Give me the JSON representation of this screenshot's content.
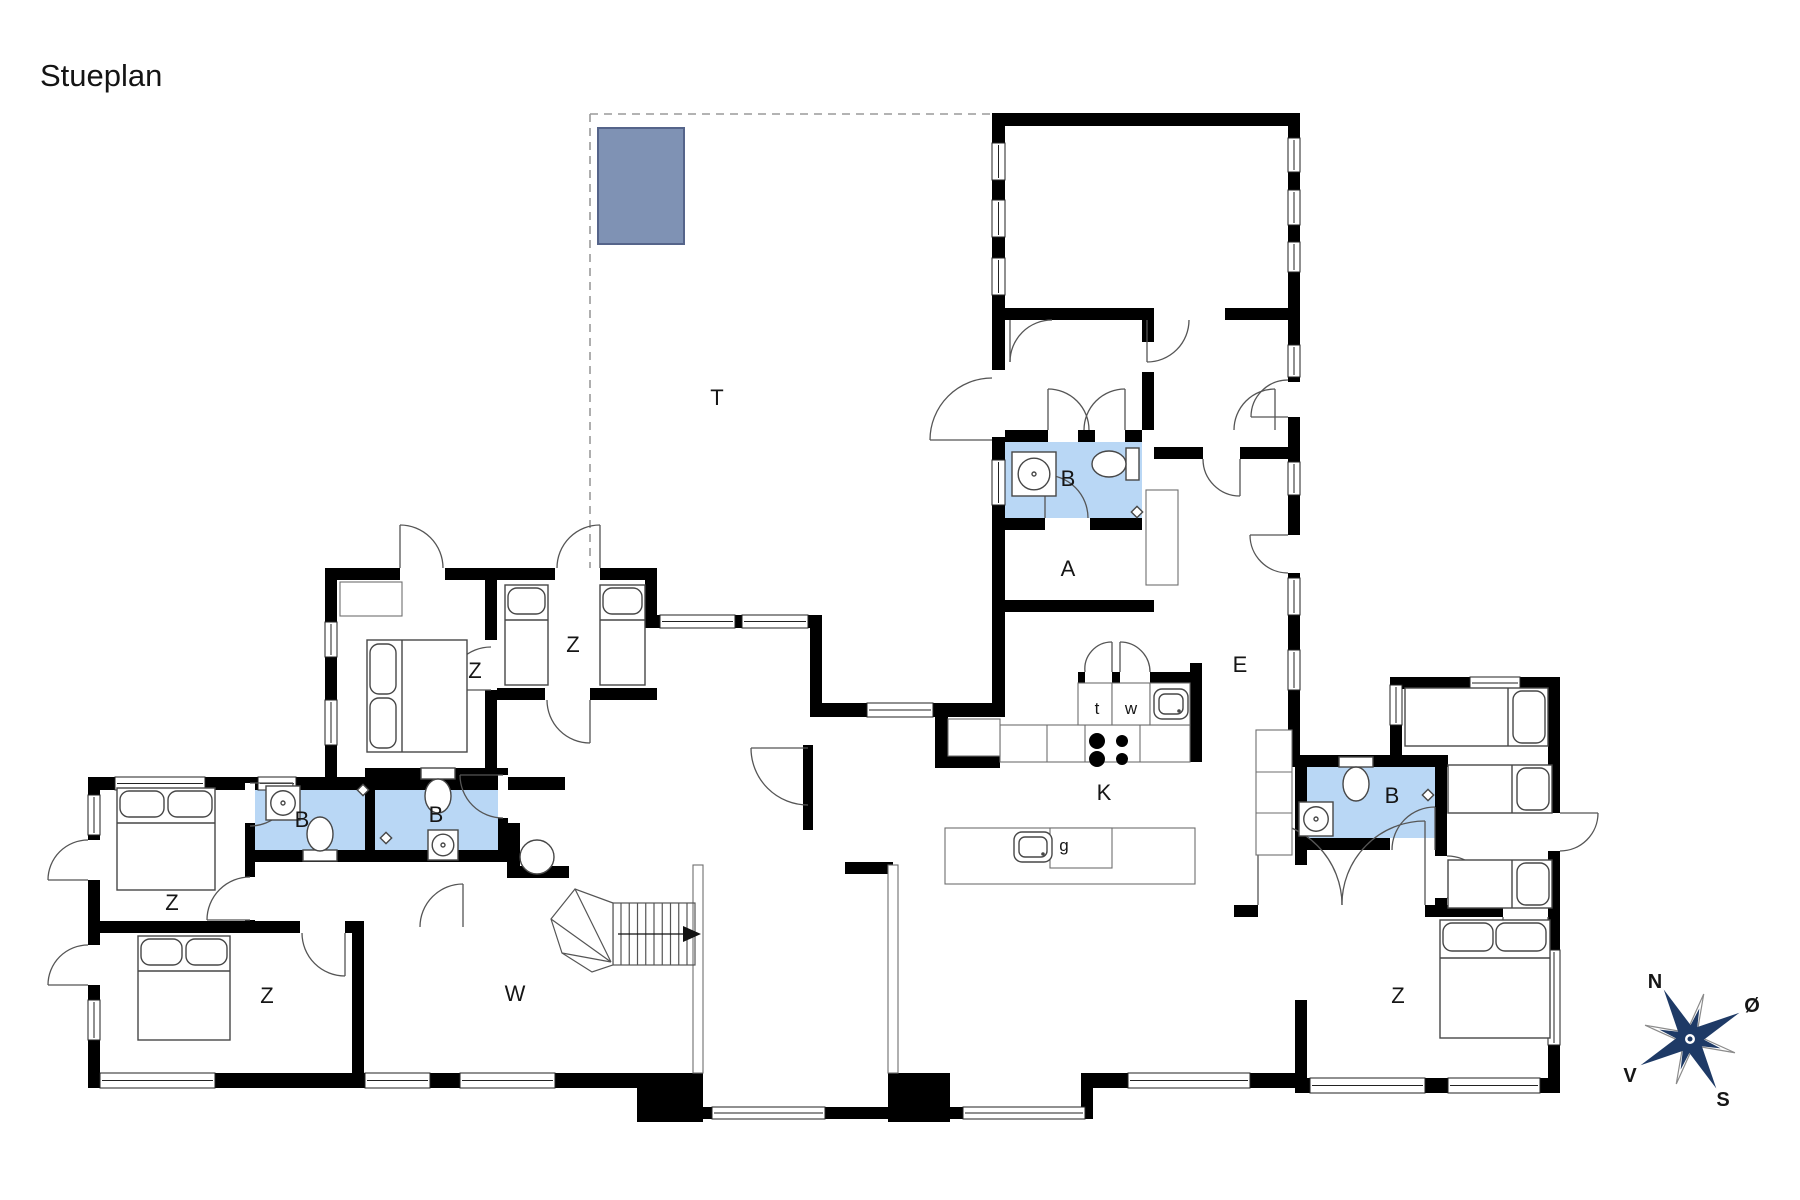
{
  "title": "Stueplan",
  "rooms": [
    {
      "id": "terrace",
      "text": "T"
    },
    {
      "id": "bedroom-upper-left",
      "text": "Z"
    },
    {
      "id": "bedroom-upper-right",
      "text": "Z"
    },
    {
      "id": "bedroom-west-top",
      "text": "Z"
    },
    {
      "id": "bedroom-west-bottom",
      "text": "Z"
    },
    {
      "id": "bedroom-east",
      "text": "Z"
    },
    {
      "id": "bathroom-west-1",
      "text": "B"
    },
    {
      "id": "bathroom-west-2",
      "text": "B"
    },
    {
      "id": "bathroom-north",
      "text": "B"
    },
    {
      "id": "bathroom-east",
      "text": "B"
    },
    {
      "id": "room-a",
      "text": "A"
    },
    {
      "id": "entrance-hall",
      "text": "E"
    },
    {
      "id": "kitchen",
      "text": "K"
    },
    {
      "id": "toilet-t",
      "text": "t"
    },
    {
      "id": "washroom-w",
      "text": "w"
    },
    {
      "id": "island-g",
      "text": "g"
    },
    {
      "id": "living-room",
      "text": "W"
    }
  ],
  "compass": {
    "north": "N",
    "east": "Ø",
    "south": "S",
    "west": "V"
  },
  "colors": {
    "bathroom_fill": "#b9d7f5",
    "wall": "#000000",
    "hot_tub_fill": "#7f92b4",
    "hot_tub_border": "#55648a",
    "compass_navy": "#1e3a66",
    "terrace_dash": "#9a9a9a"
  }
}
